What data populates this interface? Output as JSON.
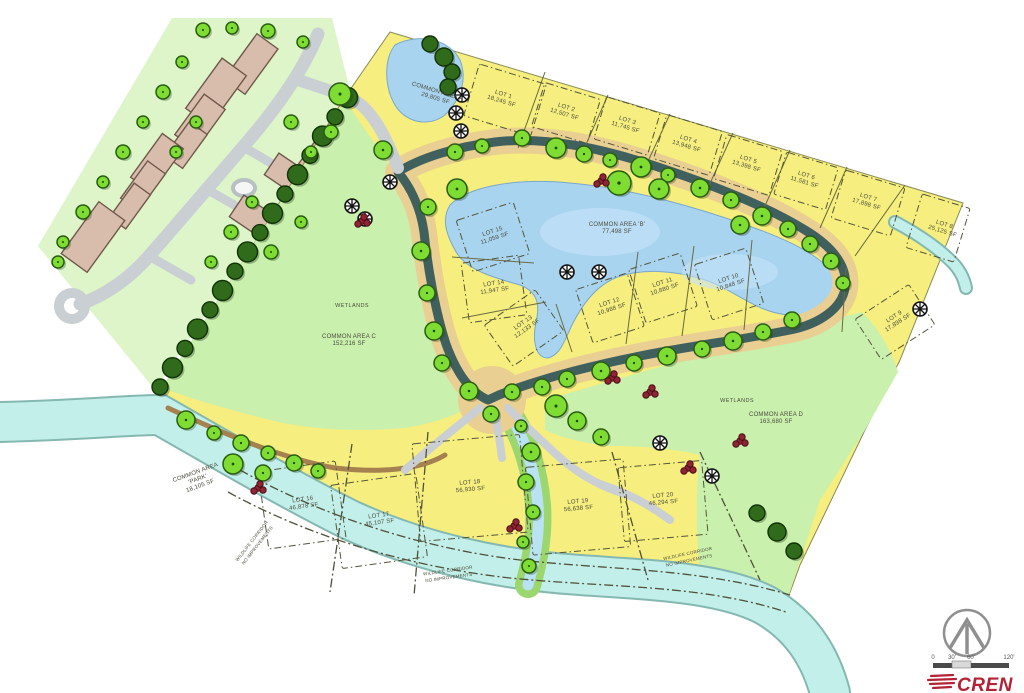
{
  "map": {
    "lots": [
      {
        "name": "LOT 1",
        "area": "18,245 SF"
      },
      {
        "name": "LOT 2",
        "area": "12,507 SF"
      },
      {
        "name": "LOT 3",
        "area": "11,745 SF"
      },
      {
        "name": "LOT 4",
        "area": "13,948 SF"
      },
      {
        "name": "LOT 5",
        "area": "13,398 SF"
      },
      {
        "name": "LOT 6",
        "area": "11,581 SF"
      },
      {
        "name": "LOT 7",
        "area": "17,898 SF"
      },
      {
        "name": "LOT 8",
        "area": "25,125 SF"
      },
      {
        "name": "LOT 9",
        "area": "17,898 SF"
      },
      {
        "name": "LOT 10",
        "area": "10,848 SF"
      },
      {
        "name": "LOT 11",
        "area": "10,880 SF"
      },
      {
        "name": "LOT 12",
        "area": "10,988 SF"
      },
      {
        "name": "LOT 13",
        "area": "12,133 SF"
      },
      {
        "name": "LOT 14",
        "area": "11,947 SF"
      },
      {
        "name": "LOT 15",
        "area": "11,059 SF"
      },
      {
        "name": "LOT 16",
        "area": "46,878 SF"
      },
      {
        "name": "LOT 17",
        "area": "45,107 SF"
      },
      {
        "name": "LOT 18",
        "area": "56,930 SF"
      },
      {
        "name": "LOT 19",
        "area": "56,638 SF"
      },
      {
        "name": "LOT 20",
        "area": "46,294 SF"
      }
    ],
    "common_areas": [
      {
        "name": "COMMON AREA A",
        "area": "29,805 SF"
      },
      {
        "name": "COMMON AREA 'B'",
        "area": "77,498 SF"
      },
      {
        "name": "COMMON AREA C",
        "area": "152,216 SF"
      },
      {
        "name": "COMMON AREA D",
        "area": "163,680 SF"
      },
      {
        "name": "COMMON AREA",
        "name2": "'PARK'",
        "area": "18,105 SF"
      }
    ],
    "wetlands_label": "WETLANDS",
    "wildlife_corridor": {
      "line1": "WILDLIFE CORRIDOR",
      "line2": "NO IMPROVEMENTS"
    }
  },
  "scale_bar": {
    "ticks": [
      "0",
      "30'",
      "60'",
      "120'"
    ]
  },
  "logo": {
    "text": "CREN"
  },
  "colors": {
    "lot_yellow": "#f6ee7e",
    "wetland_green": "#c9f0ad",
    "park_green": "#9fe45f",
    "pond_blue": "#a9d4f0",
    "river_cyan": "#c2efe9",
    "road_dark": "#40605e",
    "road_shoulder": "#e9cf92",
    "tree_green": "#7edc33",
    "logo_red": "#b22335"
  }
}
